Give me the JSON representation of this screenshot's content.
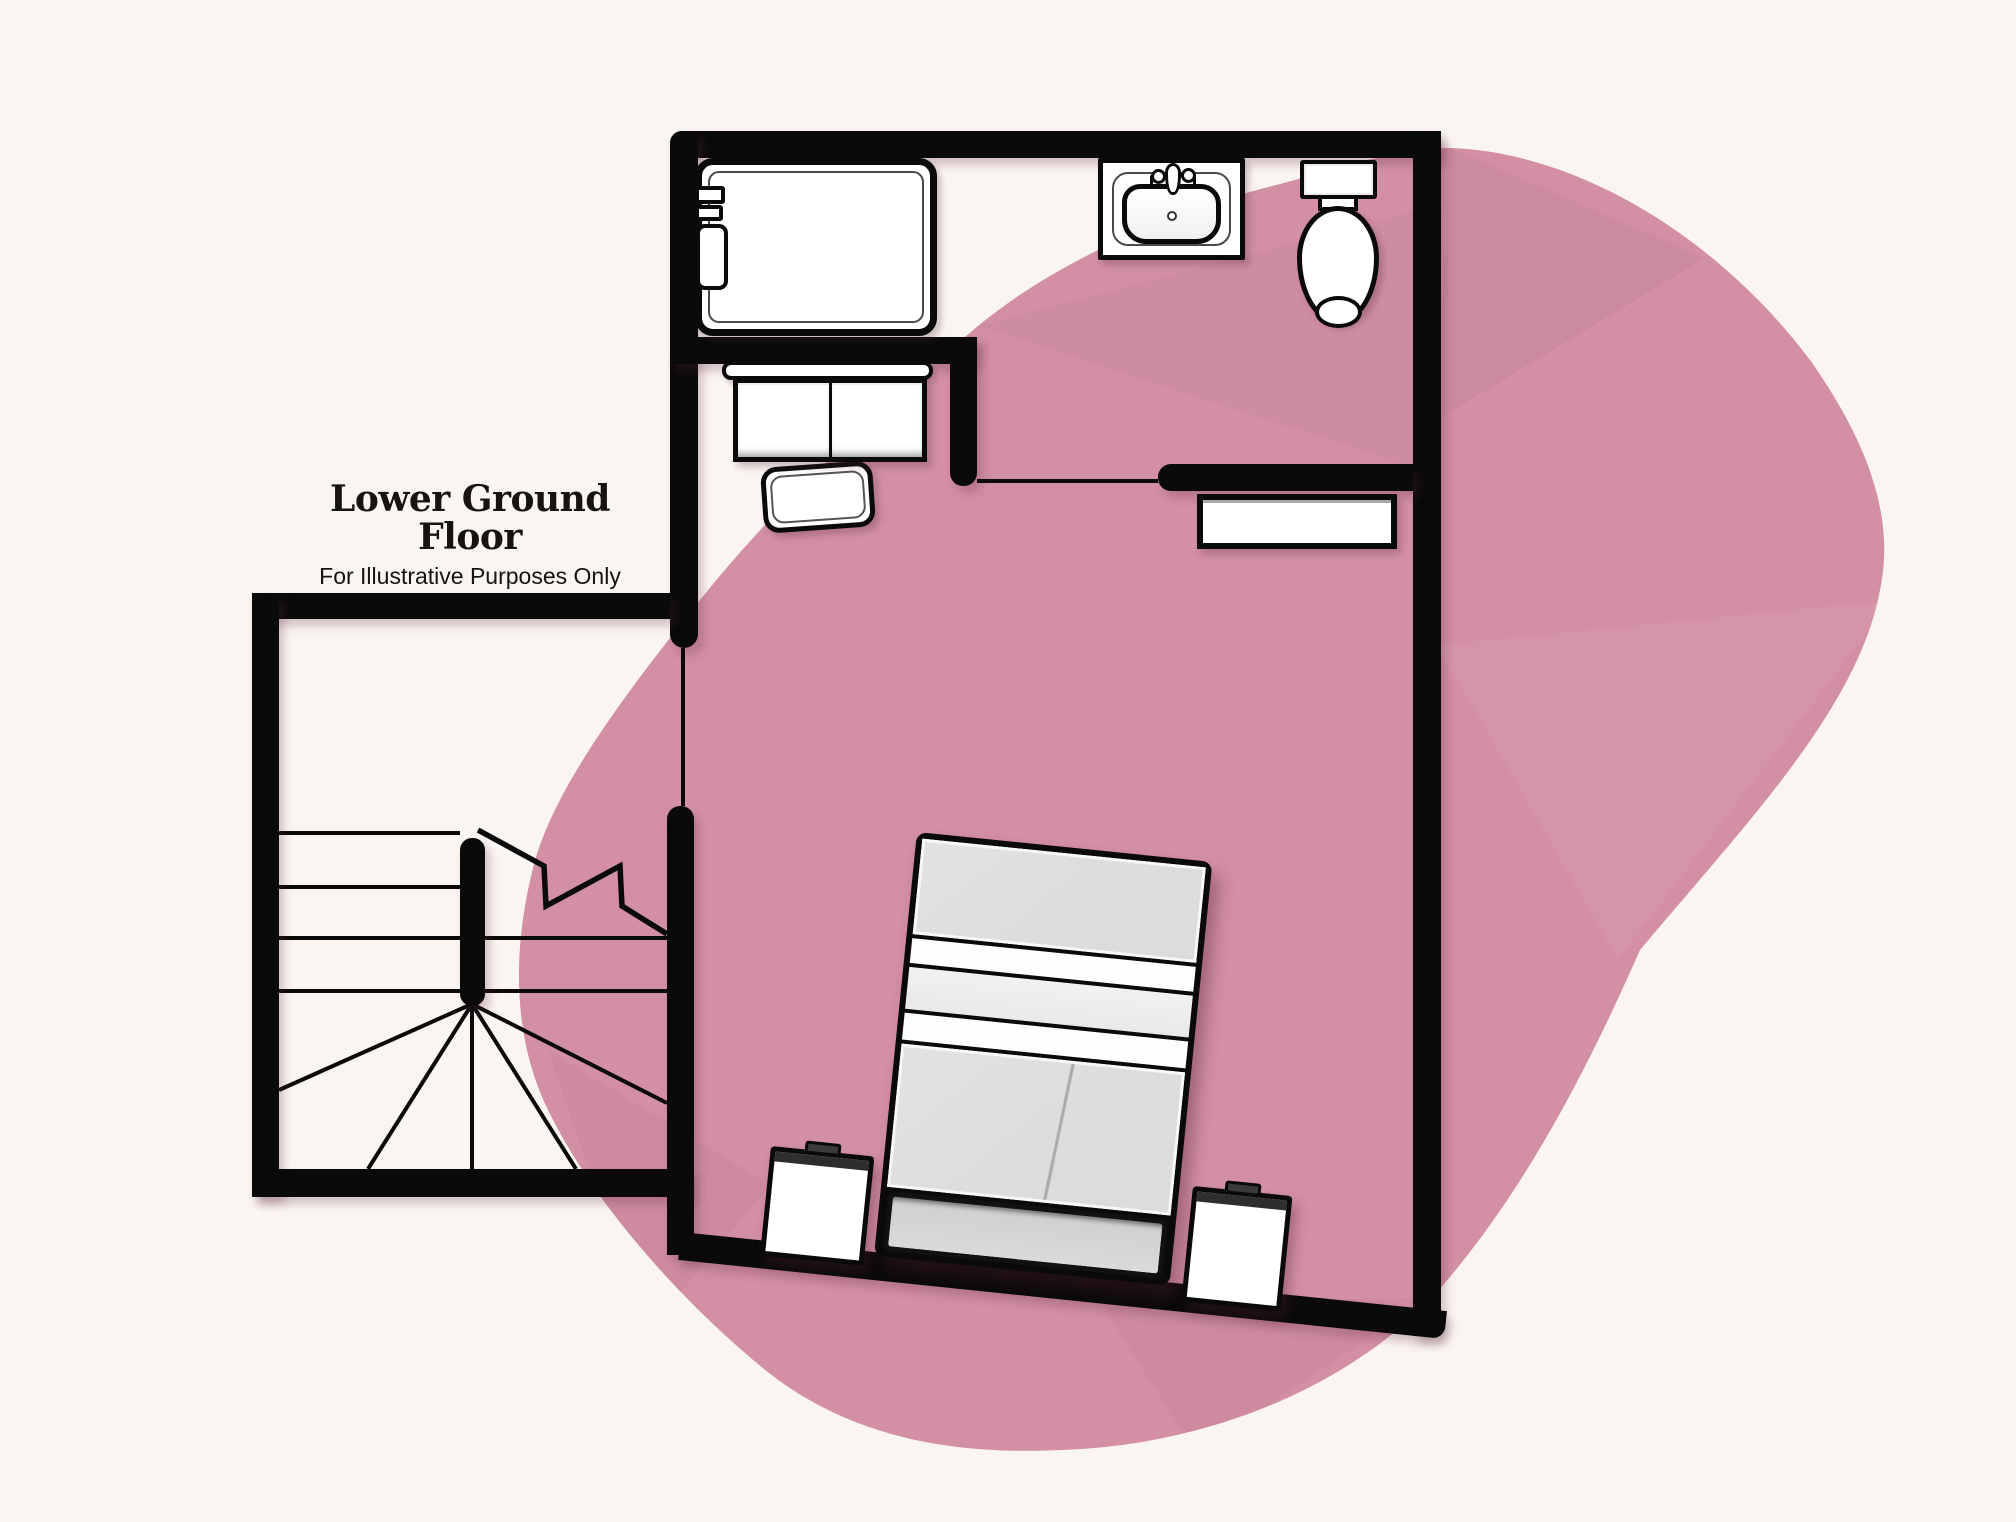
{
  "title_block": {
    "title": "Lower Ground Floor",
    "subtitle": "For Illustrative Purposes Only"
  },
  "palette": {
    "background": "#fbf5f1",
    "blob_pink": "#d38fa4",
    "wall_black": "#0a0a0a",
    "fixture_white": "#ffffff",
    "fixture_line": "#4a4a4a",
    "bed_gray": "#dcdcdc",
    "bed_gray_light": "#e9e9e9",
    "bed_white": "#fdfdfd",
    "headboard_gray": "#cfcfcf",
    "nightstand_top": "#2e2e2e"
  },
  "floor_plan": {
    "floor_name": "Lower Ground Floor",
    "fixtures": [
      {
        "icon": "bathtub-icon"
      },
      {
        "icon": "bath-taps-icon"
      },
      {
        "icon": "shower-control-icon"
      },
      {
        "icon": "vanity-unit-icon"
      },
      {
        "icon": "bath-mat-icon"
      },
      {
        "icon": "sink-icon"
      },
      {
        "icon": "toilet-icon"
      },
      {
        "icon": "wall-shelf-icon"
      },
      {
        "icon": "double-bed-icon"
      },
      {
        "icon": "nightstand-icon"
      },
      {
        "icon": "nightstand-icon"
      },
      {
        "icon": "winder-staircase-icon"
      }
    ]
  }
}
